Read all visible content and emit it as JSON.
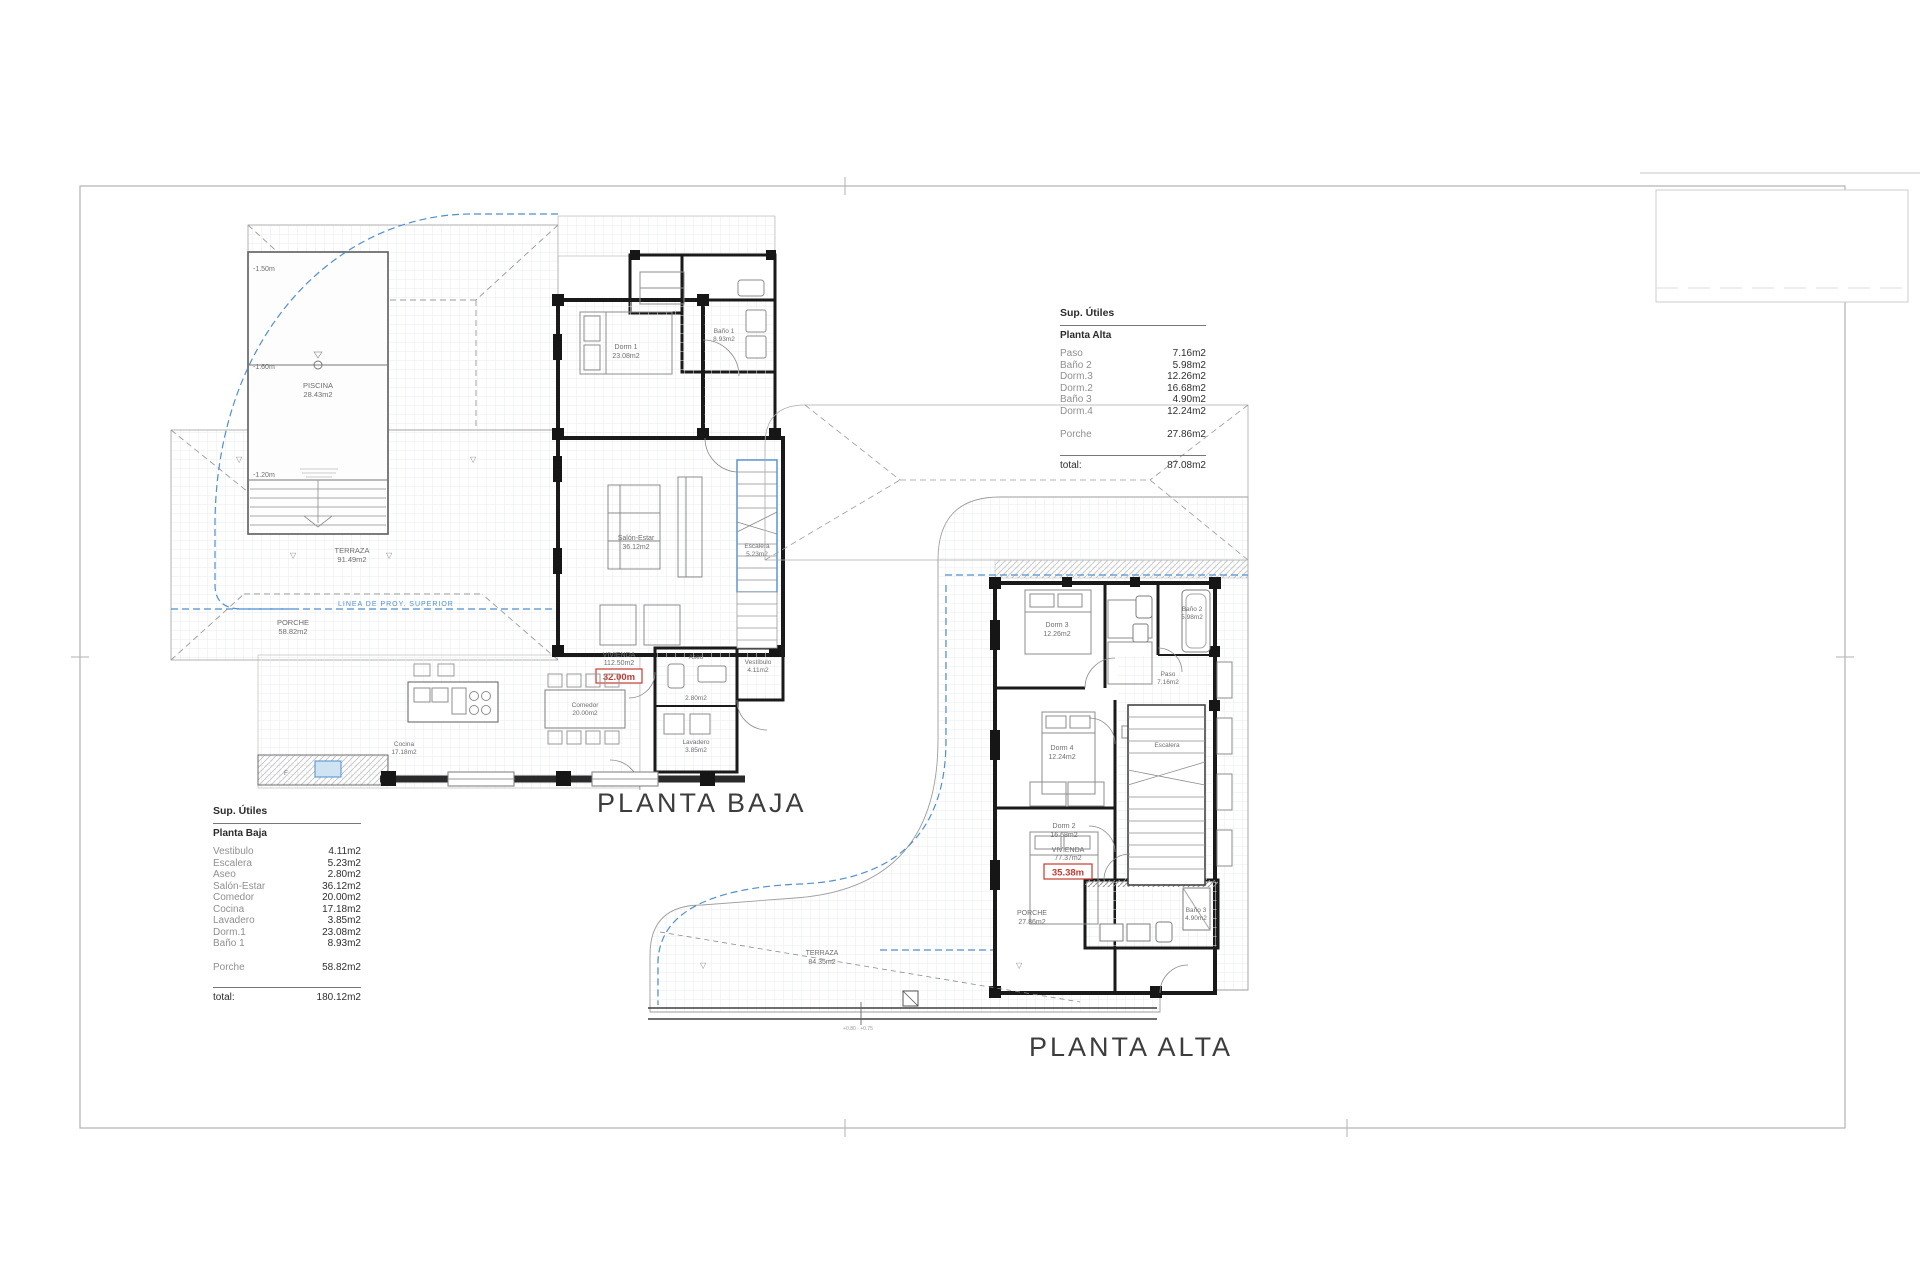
{
  "sheet": {
    "titles": {
      "baja": "PLANTA BAJA",
      "alta": "PLANTA ALTA"
    }
  },
  "tables": {
    "alta": {
      "header": "Sup. Útiles",
      "subheader": "Planta Alta",
      "rows": [
        {
          "label": "Paso",
          "value": "7.16m2"
        },
        {
          "label": "Baño 2",
          "value": "5.98m2"
        },
        {
          "label": "Dorm.3",
          "value": "12.26m2"
        },
        {
          "label": "Dorm.2",
          "value": "16.68m2"
        },
        {
          "label": "Baño 3",
          "value": "4.90m2"
        },
        {
          "label": "Dorm.4",
          "value": "12.24m2"
        }
      ],
      "porche": {
        "label": "Porche",
        "value": "27.86m2"
      },
      "total_label": "total:",
      "total_value": "87.08m2"
    },
    "baja": {
      "header": "Sup. Útiles",
      "subheader": "Planta Baja",
      "rows": [
        {
          "label": "Vestibulo",
          "value": "4.11m2"
        },
        {
          "label": "Escalera",
          "value": "5.23m2"
        },
        {
          "label": "Aseo",
          "value": "2.80m2"
        },
        {
          "label": "Salón-Estar",
          "value": "36.12m2"
        },
        {
          "label": "Comedor",
          "value": "20.00m2"
        },
        {
          "label": "Cocina",
          "value": "17.18m2"
        },
        {
          "label": "Lavadero",
          "value": "3.85m2"
        },
        {
          "label": "Dorm.1",
          "value": "23.08m2"
        },
        {
          "label": "Baño 1",
          "value": "8.93m2"
        }
      ],
      "porche": {
        "label": "Porche",
        "value": "58.82m2"
      },
      "total_label": "total:",
      "total_value": "180.12m2"
    }
  },
  "plan_baja": {
    "piscina_name": "PISCINA",
    "piscina_area": "28.43m2",
    "level_top": "-1.50m",
    "level_mid": "-1.60m",
    "level_bottom": "-1.20m",
    "terraza_name": "TERRAZA",
    "terraza_area": "91.49m2",
    "porche_name": "PORCHE",
    "porche_area": "58.82m2",
    "linea": "LINEA DE PROY. SUPERIOR",
    "dorm1_name": "Dorm 1",
    "dorm1_area": "23.08m2",
    "bano1_name": "Baño 1",
    "bano1_area": "8.93m2",
    "salon_name": "Salón-Estar",
    "salon_area": "36.12m2",
    "escalera_name": "Escalera",
    "escalera_area": "5.23m2",
    "vivienda_name": "VIVIENDA",
    "vivienda_area": "112.50m2",
    "nivel": "32.00m",
    "aseo_name": "Aseo",
    "aseo_area": "2.80m2",
    "vestibulo_name": "Vestíbulo",
    "vestibulo_area": "4.11m2",
    "lavadero_name": "Lavadero",
    "lavadero_area": "3.85m2",
    "cocina_name": "Cocina",
    "cocina_area": "17.18m2",
    "comedor_name": "Comedor",
    "comedor_area": "20.00m2"
  },
  "plan_alta": {
    "dorm2_name": "Dorm 2",
    "dorm2_area": "16.68m2",
    "dorm3_name": "Dorm 3",
    "dorm3_area": "12.26m2",
    "dorm4_name": "Dorm 4",
    "dorm4_area": "12.24m2",
    "bano2_name": "Baño 2",
    "bano2_area": "5.98m2",
    "bano3_name": "Baño 3",
    "bano3_area": "4.90m2",
    "paso_name": "Paso",
    "paso_area": "7.16m2",
    "escalera_name": "Escalera",
    "vivienda_name": "VIVIENDA",
    "vivienda_area": "77.37m2",
    "nivel": "35.38m",
    "porche_name": "PORCHE",
    "porche_area": "27.86m2",
    "terraza_name": "TERRAZA",
    "terraza_area": "84.35m2",
    "linea": "LINEA DE PROY. SUPERIOR",
    "note": "+0.80 · +0.75"
  },
  "colors": {
    "blue": "#4f8fce",
    "red": "#c43a31",
    "wall": "#1a1a1a"
  }
}
